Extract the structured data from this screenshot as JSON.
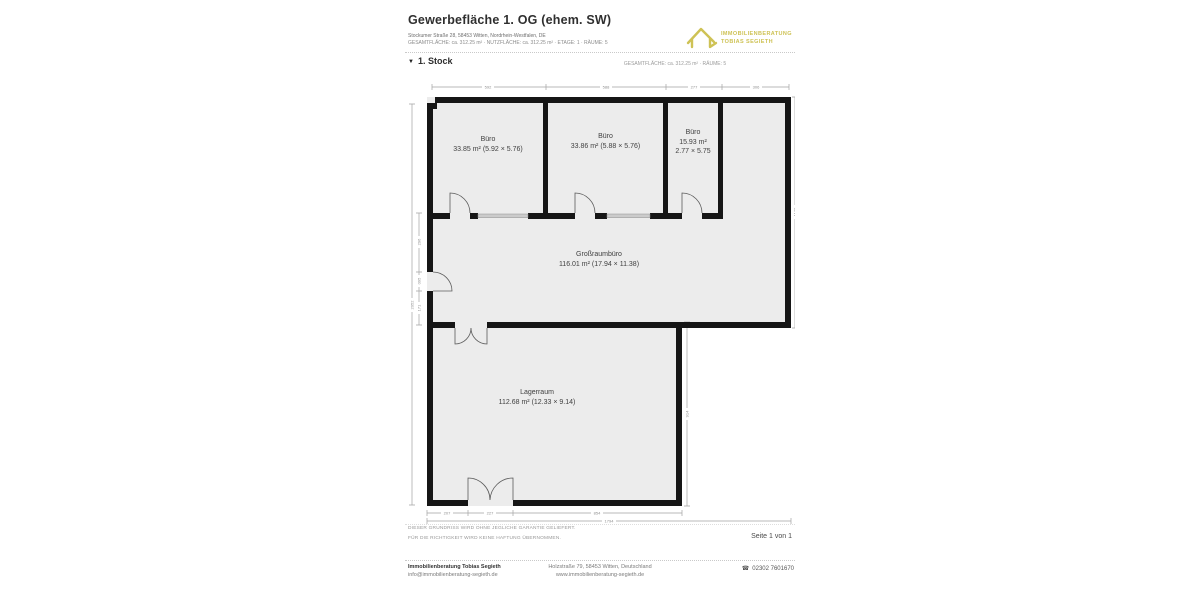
{
  "header": {
    "title": "Gewerbefläche 1. OG (ehem. SW)",
    "address": "Stockumer Straße 28, 58453 Witten, Nordrhein-Westfalen, DE",
    "meta": "GESAMTFLÄCHE: ca. 312.25 m² · NUTZFLÄCHE: ca. 312.25 m² · ETAGE: 1 · RÄUME: 5",
    "logo": {
      "line1": "IMMOBILIENBERATUNG",
      "line2": "TOBIAS SEGIETH"
    }
  },
  "floor_section": {
    "collapse_icon": "▼",
    "label": "1. Stock",
    "summary": "GESAMTFLÄCHE: ca. 312.25 m² · RÄUME: 5"
  },
  "plan": {
    "rooms": [
      {
        "name": "Büro",
        "line2": "33.85 m² (5.92 × 5.76)"
      },
      {
        "name": "Büro",
        "line2": "33.86 m² (5.88 × 5.76)"
      },
      {
        "name": "Büro",
        "line2": "15.93 m²",
        "line3": "2.77 × 5.75"
      },
      {
        "name": "Großraumbüro",
        "line2": "116.01 m² (17.94 × 11.38)"
      },
      {
        "name": "Lagerraum",
        "line2": "112.68 m² (12.33 × 9.14)"
      }
    ],
    "dims": {
      "t1": "592",
      "t2": "588",
      "t3": "277",
      "t4": "306",
      "l0": "2052",
      "l1": "296",
      "l2": "095",
      "l3": "171",
      "r1": "1138",
      "r2": "914",
      "b1": "207",
      "b2": "227",
      "b3": "854",
      "b0": "1794"
    }
  },
  "disclaimer": {
    "line1": "DIESER GRUNDRISS WIRD OHNE JEGLICHE GARANTIE GELIEFERT.",
    "line2": "FÜR DIE RICHTIGKEIT WIRD KEINE HAFTUNG ÜBERNOMMEN."
  },
  "page_indicator": "Seite 1 von 1",
  "footer": {
    "company": "Immobilienberatung Tobias Segieth",
    "email": "info@immobilienberatung-segieth.de",
    "address": "Holzstraße 79, 58453 Witten, Deutschland",
    "website": "www.immobilienberatung-segieth.de",
    "phone_icon": "☎",
    "phone": "02302 7601670"
  },
  "colors": {
    "brand_yellow": "#cec255",
    "wall": "#161616",
    "room_fill": "#ececec"
  }
}
